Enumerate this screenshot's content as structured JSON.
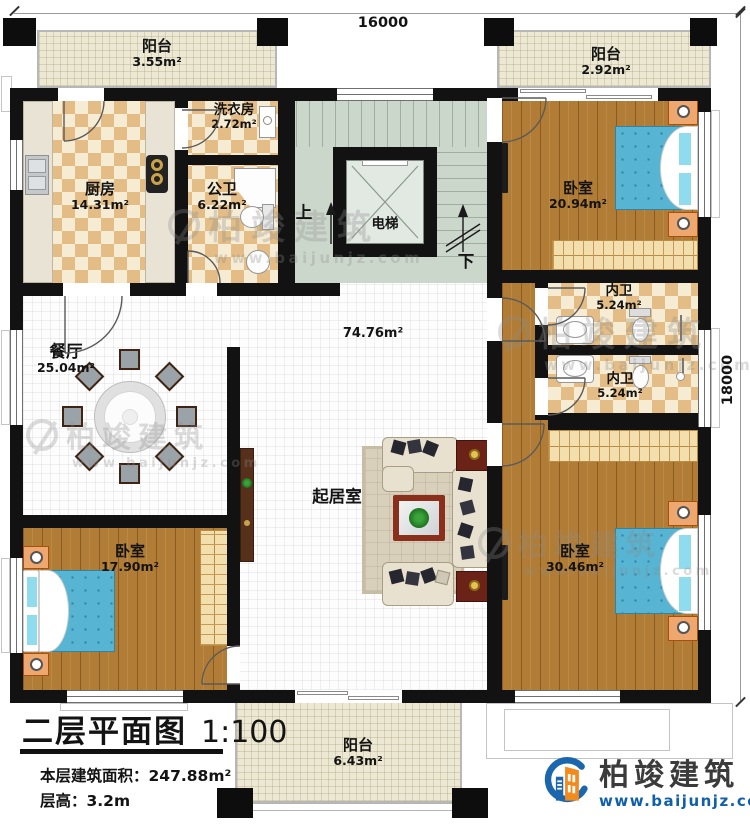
{
  "dimensions": {
    "top": "16000",
    "right": "18000"
  },
  "rooms": {
    "balcony_tl": {
      "name": "阳台",
      "area": "3.55m²"
    },
    "balcony_tr": {
      "name": "阳台",
      "area": "2.92m²"
    },
    "kitchen": {
      "name": "厨房",
      "area": "14.31m²"
    },
    "laundry": {
      "name": "洗衣房",
      "area": "2.72m²"
    },
    "public_bath": {
      "name": "公卫",
      "area": "6.22m²"
    },
    "elevator": {
      "name": "电梯"
    },
    "stair_up": {
      "name": "上"
    },
    "stair_down": {
      "name": "下"
    },
    "bedroom_tr": {
      "name": "卧室",
      "area": "20.94m²"
    },
    "inner_bath_1": {
      "name": "内卫",
      "area": "5.24m²"
    },
    "inner_bath_2": {
      "name": "内卫",
      "area": "5.24m²"
    },
    "dining": {
      "name": "餐厅",
      "area": "25.04m²"
    },
    "living_area": {
      "area": "74.76m²"
    },
    "living_room": {
      "name": "起居室"
    },
    "bedroom_left": {
      "name": "卧室",
      "area": "17.90m²"
    },
    "bedroom_br": {
      "name": "卧室",
      "area": "30.46m²"
    },
    "balcony_bottom": {
      "name": "阳台",
      "area": "6.43m²"
    }
  },
  "title_block": {
    "title": "二层平面图",
    "scale": "1:100",
    "area_line": "本层建筑面积：247.88m²",
    "height_line": "层高：3.2m"
  },
  "branding": {
    "company": "柏竣建筑",
    "website": "www.baijunjz.com"
  },
  "watermark": {
    "text": "柏竣建筑",
    "website": "www.baijunjz.com"
  },
  "colors": {
    "wall": "#121212",
    "wood_floor": "#b17d36",
    "tile_dark": "#e3bd85",
    "tile_light": "#f6ecd3",
    "balcony": "#ece8d3",
    "stairwell": "#ccd7cc",
    "bed": "#57b4d2",
    "brand_blue": "#1b67ad",
    "brand_orange": "#f28a1e"
  }
}
